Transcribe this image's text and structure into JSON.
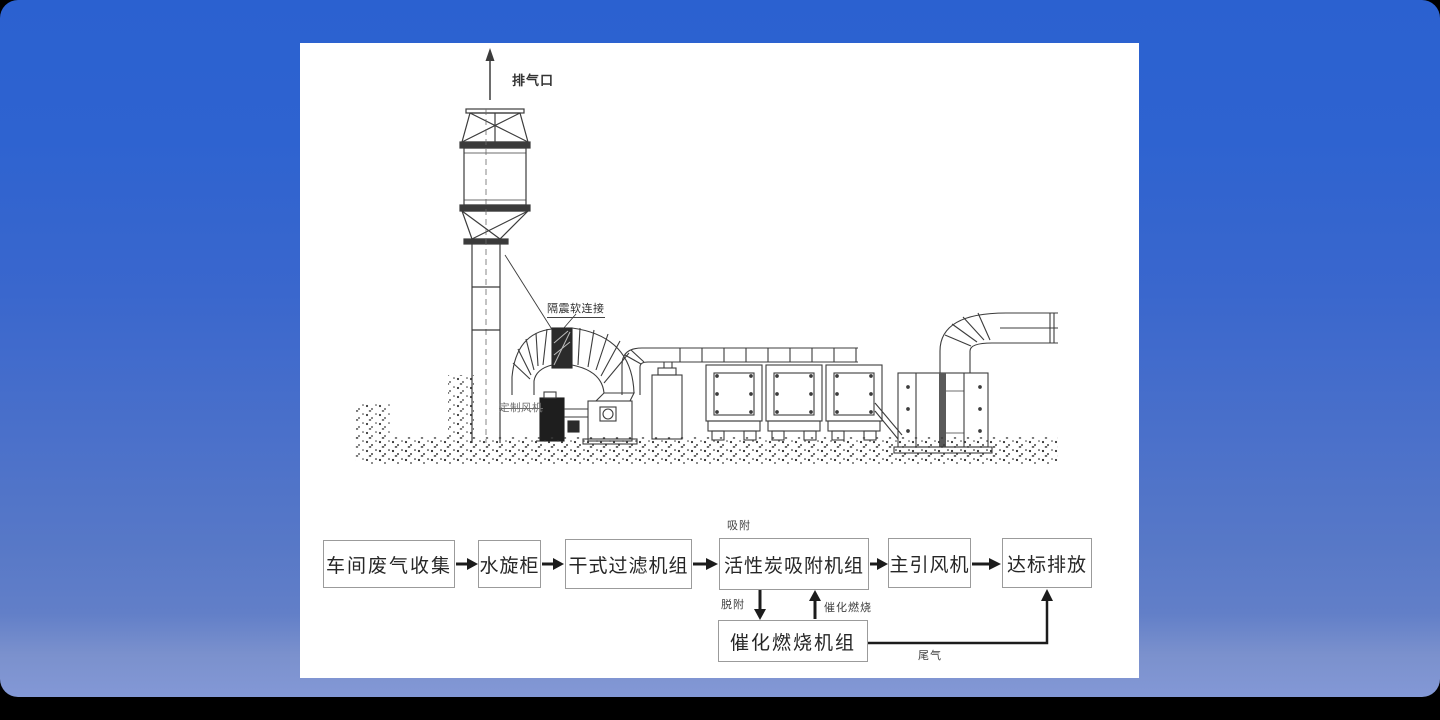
{
  "scene": {
    "background_color": "#000000",
    "card_color_top": "#2b61d0",
    "card_color_bottom": "#8398d6",
    "panel_color": "#ffffff"
  },
  "illustration": {
    "labels": {
      "exhaust_outlet": "排气口",
      "flexible_connector": "隔震软连接",
      "custom_fan": "定制风机"
    }
  },
  "flowchart": {
    "adsorption_label": "吸附",
    "desorption_label": "脱附",
    "catalytic_combustion_label": "催化燃烧",
    "tail_gas_label": "尾气",
    "boxes": [
      {
        "label": "车间废气收集"
      },
      {
        "label": "水旋柜"
      },
      {
        "label": "干式过滤机组"
      },
      {
        "label": "活性炭吸附机组"
      },
      {
        "label": "主引风机"
      },
      {
        "label": "达标排放"
      }
    ],
    "bottom_box": {
      "label": "催化燃烧机组"
    }
  }
}
